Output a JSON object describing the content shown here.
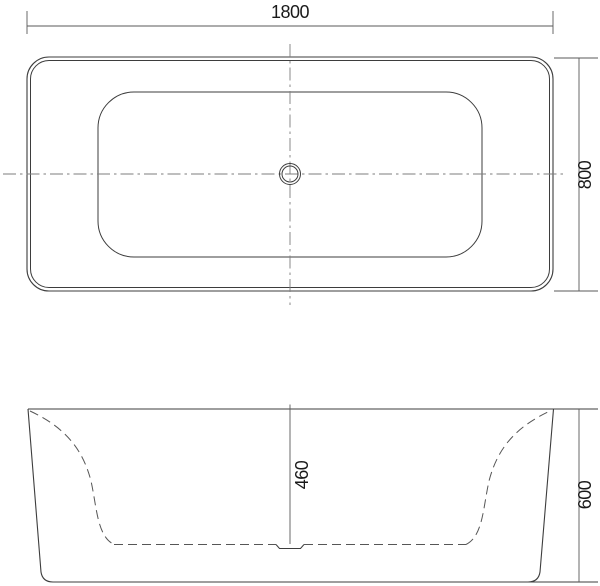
{
  "colors": {
    "background": "#ffffff",
    "line": "#3d3d3d",
    "hidden": "#565656",
    "centerline": "#7d7d7d",
    "dimension": "#5a5a5a",
    "text": "#1a1a1a"
  },
  "dimensions": {
    "top_width": "1800",
    "top_depth": "800",
    "basin_depth": "460",
    "overall_height": "600"
  }
}
